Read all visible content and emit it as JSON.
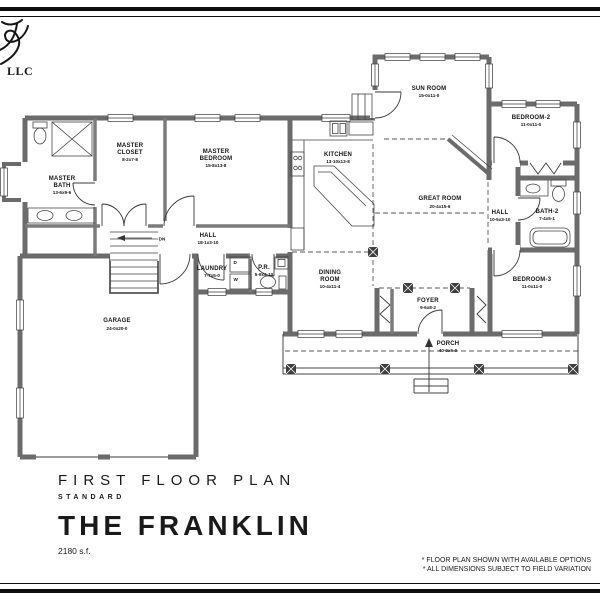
{
  "logo": {
    "company_suffix": "LLC"
  },
  "title_block": {
    "plan_title": "FIRST FLOOR PLAN",
    "plan_variant": "STANDARD",
    "model_name": "THE FRANKLIN",
    "area": "2180 s.f."
  },
  "notes": [
    "* FLOOR PLAN SHOWN WITH AVAILABLE OPTIONS",
    "* ALL DIMENSIONS SUBJECT TO FIELD VARIATION"
  ],
  "rooms": {
    "sun_room": {
      "lines": [
        "SUN ROOM"
      ],
      "dims": "15-0x11-0"
    },
    "bedroom_2": {
      "lines": [
        "BEDROOM-2"
      ],
      "dims": "11-0x11-0"
    },
    "master_closet": {
      "lines": [
        "MASTER",
        "CLOSET"
      ],
      "dims": "8-2x7-8"
    },
    "master_bedroom": {
      "lines": [
        "MASTER",
        "BEDROOM"
      ],
      "dims": "15-8x13-8"
    },
    "master_bath": {
      "lines": [
        "MASTER",
        "BATH"
      ],
      "dims": "13-6x9-6"
    },
    "kitchen": {
      "lines": [
        "KITCHEN"
      ],
      "dims": "13-10x13-8"
    },
    "great_room": {
      "lines": [
        "GREAT ROOM"
      ],
      "dims": "20-4x15-6"
    },
    "hall_master": {
      "lines": [
        "HALL"
      ],
      "dims": "18-1x3-10"
    },
    "laundry": {
      "lines": [
        "LAUNDRY"
      ],
      "dims": "7-7x5-0"
    },
    "powder_room": {
      "lines": [
        "P.R."
      ],
      "dims": "5-9x4-10"
    },
    "dining_room": {
      "lines": [
        "DINING",
        "ROOM"
      ],
      "dims": "10-4x11-4"
    },
    "foyer": {
      "lines": [
        "FOYER"
      ],
      "dims": "9-6x8-2"
    },
    "garage": {
      "lines": [
        "GARAGE"
      ],
      "dims": "24-0x20-0"
    },
    "hall_bedroom": {
      "lines": [
        "HALL"
      ],
      "dims": "10-5x3-10"
    },
    "bath_2": {
      "lines": [
        "BATH-2"
      ],
      "dims": "7-4x5-1"
    },
    "bedroom_3": {
      "lines": [
        "BEDROOM-3"
      ],
      "dims": "11-0x11-0"
    },
    "porch": {
      "lines": [
        "PORCH"
      ],
      "dims": "40-0x6-0"
    }
  },
  "annotations": {
    "stair_direction": "DN",
    "dryer": "D",
    "washer": "W"
  },
  "colors": {
    "ink": "#1a1a1a",
    "wall": "#6b6b6b",
    "wall_light": "#7b7b7b"
  }
}
